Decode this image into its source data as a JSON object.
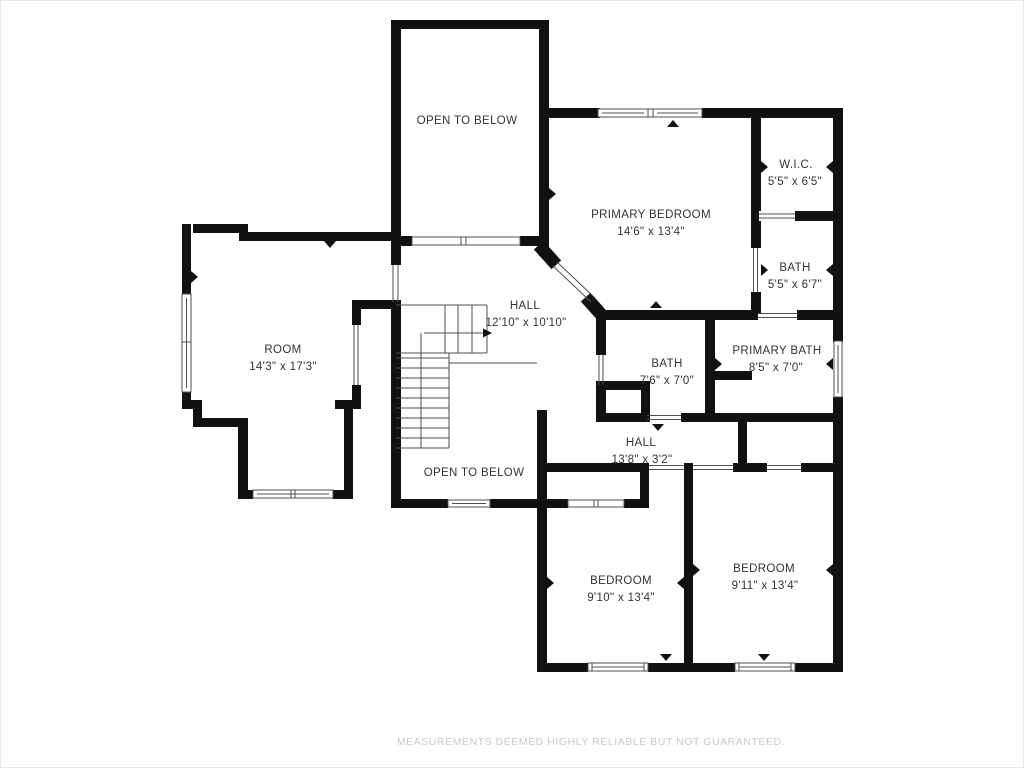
{
  "plan": {
    "title": "Second floor plan",
    "labels": {
      "open_below_top": {
        "name": "OPEN TO BELOW"
      },
      "primary_bedroom": {
        "name": "PRIMARY BEDROOM",
        "dims": "14'6\" x 13'4\""
      },
      "wic": {
        "name": "W.I.C.",
        "dims": "5'5\" x 6'5\""
      },
      "bath_small": {
        "name": "BATH",
        "dims": "5'5\" x 6'7\""
      },
      "hall_main": {
        "name": "HALL",
        "dims": "12'10\" x 10'10\""
      },
      "room": {
        "name": "ROOM",
        "dims": "14'3\" x 17'3\""
      },
      "hall_bath": {
        "name": "BATH",
        "dims": "7'6\" x 7'0\""
      },
      "primary_bath": {
        "name": "PRIMARY BATH",
        "dims": "8'5\" x 7'0\""
      },
      "hall_lower": {
        "name": "HALL",
        "dims": "13'8\" x 3'2\""
      },
      "open_below_mid": {
        "name": "OPEN TO BELOW"
      },
      "bedroom_1": {
        "name": "BEDROOM",
        "dims": "9'10\" x 13'4\""
      },
      "bedroom_2": {
        "name": "BEDROOM",
        "dims": "9'11\" x 13'4\""
      }
    },
    "footer": {
      "disclaimer": "MEASUREMENTS DEEMED HIGHLY RELIABLE BUT NOT GUARANTEED."
    },
    "colors": {
      "wall": "#111111",
      "thin_line": "#4f4f4f",
      "label_text": "#333333",
      "disclaimer_text": "#c9c9c9",
      "background": "#ffffff"
    }
  }
}
